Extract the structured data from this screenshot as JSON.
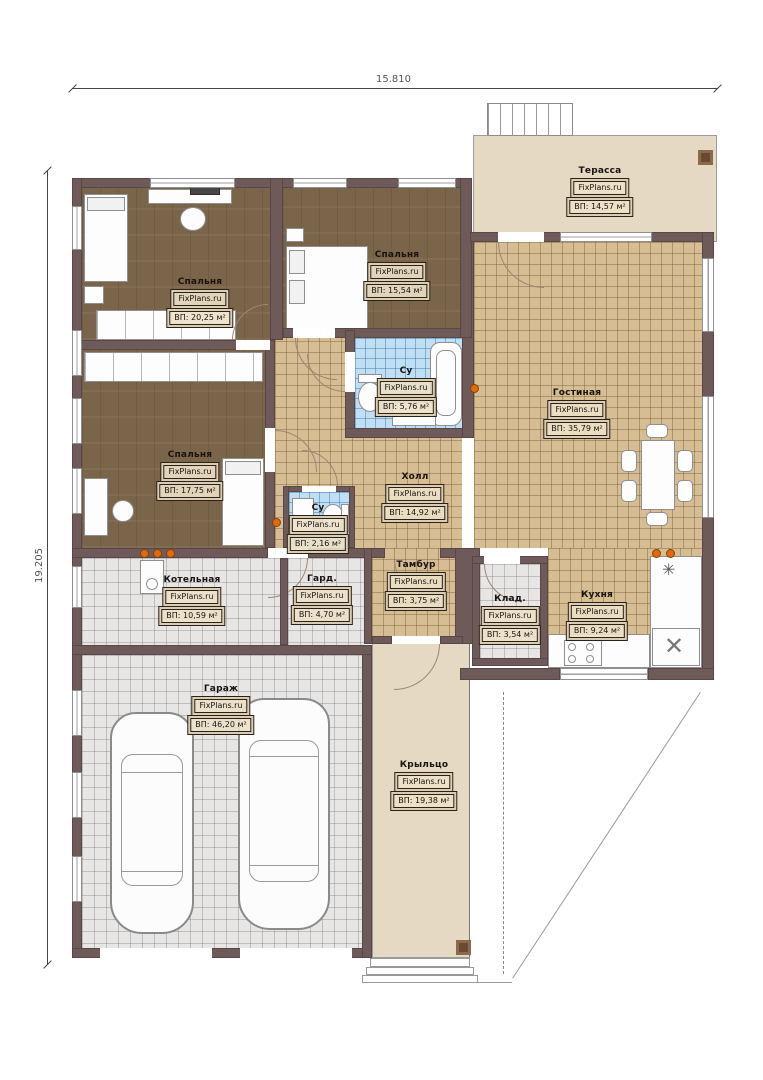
{
  "dimensions": {
    "top": "15.810",
    "left": "19.205"
  },
  "watermark": "FixPlans.ru",
  "icons": {
    "sink_glyph": "✳",
    "fridge_glyph": "✕"
  },
  "colors": {
    "wall": "#6d5a59",
    "wood_floor": "#7b654a",
    "tile_beige": "#d6bd93",
    "tile_blue": "#bedff4",
    "tile_gray": "#e7e6e4",
    "deck": "#e5d9c3",
    "vent_dot": "#e06a10"
  },
  "rooms": [
    {
      "name": "Терасса",
      "area": "ВП: 14,57 м²"
    },
    {
      "name": "Спальня",
      "area": "ВП: 20,25 м²"
    },
    {
      "name": "Спальня",
      "area": "ВП: 15,54 м²"
    },
    {
      "name": "Су",
      "area": "ВП: 5,76 м²"
    },
    {
      "name": "Гостиная",
      "area": "ВП: 35,79 м²"
    },
    {
      "name": "Спальня",
      "area": "ВП: 17,75 м²"
    },
    {
      "name": "Су",
      "area": "ВП: 2,16 м²"
    },
    {
      "name": "Холл",
      "area": "ВП: 14,92 м²"
    },
    {
      "name": "Котельная",
      "area": "ВП: 10,59 м²"
    },
    {
      "name": "Гард.",
      "area": "ВП: 4,70 м²"
    },
    {
      "name": "Тамбур",
      "area": "ВП: 3,75 м²"
    },
    {
      "name": "Клад.",
      "area": "ВП: 3,54 м²"
    },
    {
      "name": "Кухня",
      "area": "ВП: 9,24 м²"
    },
    {
      "name": "Гараж",
      "area": "ВП: 46,20 м²"
    },
    {
      "name": "Крыльцо",
      "area": "ВП: 19,38 м²"
    }
  ]
}
